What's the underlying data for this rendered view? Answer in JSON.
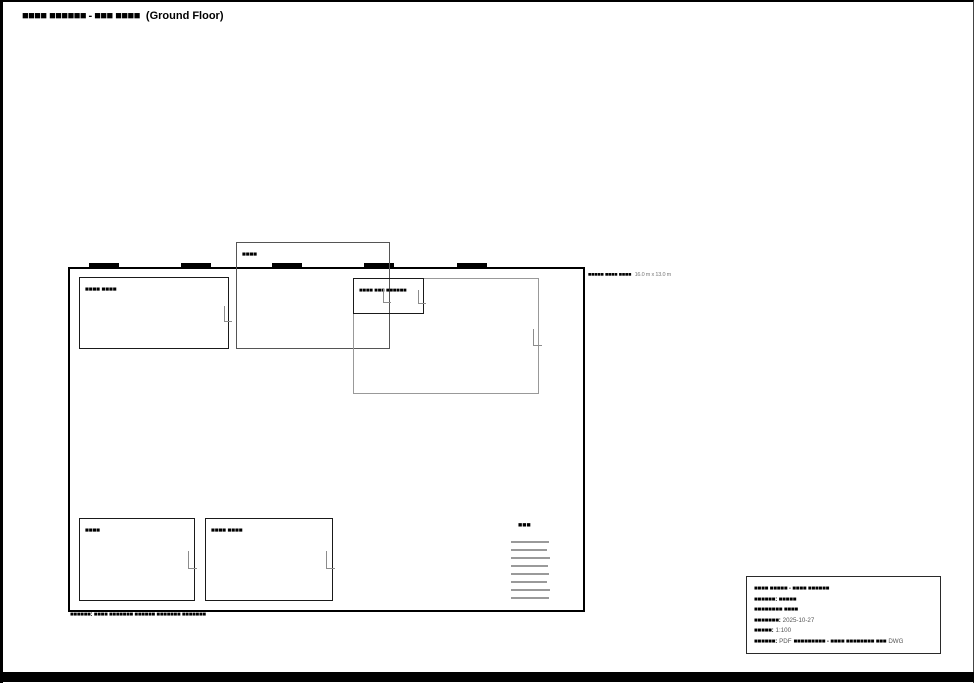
{
  "title": {
    "redacted": "■■■■ ■■■■■■ - ■■■ ■■■■",
    "visible": "(Ground Floor)"
  },
  "plan": {
    "room_top_left_label": "■■■■ ■■■■",
    "entry_label": "■■■■",
    "room_center_label": "■■■■ ■■■ ■■■■■■",
    "room_bottom_left_label": "■■■■",
    "room_bottom_mid_label": "■■■■ ■■■■",
    "stairs_label": "■■■",
    "side_note_redacted": "■■■■■ ■■■■ ■■■■",
    "side_note_dimensions": "16.0 m x 13.0 m",
    "bottom_note": "■■■■■■: ■■■■ ■■■■■■■ ■■■■■■ ■■■■■■■ ■■■■■■■"
  },
  "titleblock": {
    "line1": "■■■■ ■■■■■ - ■■■■ ■■■■■■",
    "line2": "■■■■■■: ■■■■■",
    "line3": "■■■■■■■■ ■■■■",
    "date_label": "■■■■■■■:",
    "date_value": "2025-10-27",
    "scale_label": "■■■■■:",
    "scale_value": "1:100",
    "export_label": "■■■■■■:",
    "export_value_1": "PDF",
    "export_redacted": "■■■■■■■■■ - ■■■■ ■■■■■■■■ ■■■",
    "export_value_2": "DWG"
  },
  "colors": {
    "wall": "#000000",
    "light_line": "#999999",
    "muted_text": "#555555"
  }
}
